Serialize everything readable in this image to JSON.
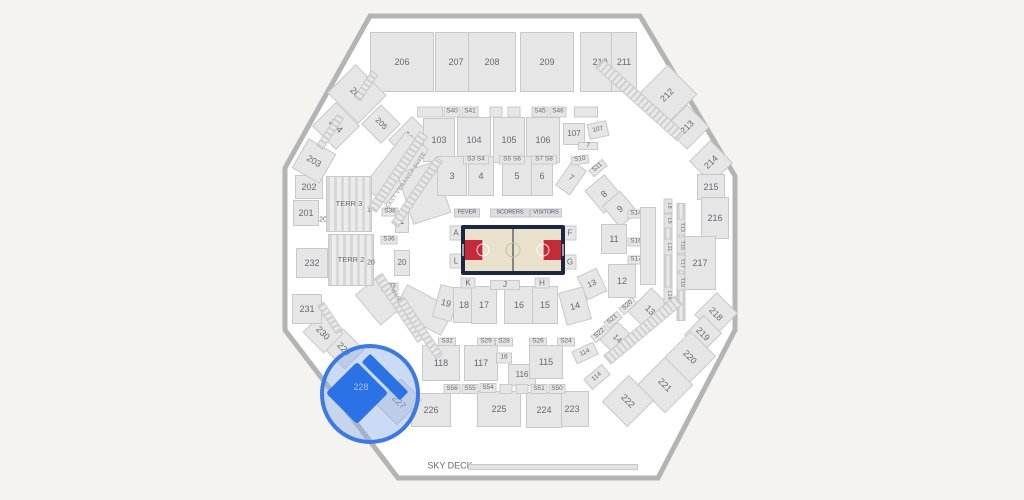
{
  "selection": {
    "section": "228"
  },
  "colors": {
    "bg": "#f5f3ef",
    "arenaFill": "#ffffff",
    "arenaStroke": "#b4b4b4",
    "secFill": "#e6e6e6",
    "secEdge": "#c9c9c9",
    "secText": "#68686f",
    "navy": "#1b2843",
    "floor": "#e9e1cb",
    "red": "#c62a39",
    "selFill": "#2a72e6",
    "selRing": "#3b7ae2",
    "selHalo": "rgba(141,175,232,0.45)",
    "selText": "#a5bfe8"
  },
  "court": {
    "bench_labels": [
      "FEVER",
      "SCORERS",
      "VISITORS"
    ]
  },
  "map": {
    "blocks": [
      [
        "206",
        402,
        62,
        64,
        60,
        0,
        "sec"
      ],
      [
        "207",
        456,
        62,
        42,
        60,
        0,
        "sec"
      ],
      [
        "208",
        492,
        62,
        48,
        60,
        0,
        "sec"
      ],
      [
        "209",
        547,
        62,
        54,
        60,
        0,
        "sec"
      ],
      [
        "210",
        600,
        62,
        40,
        60,
        0,
        "sec"
      ],
      [
        "211",
        624,
        62,
        26,
        60,
        0,
        "sec"
      ],
      [
        "205",
        357,
        94,
        44,
        40,
        45,
        "sec"
      ],
      [
        "205",
        381,
        124,
        28,
        28,
        45,
        "sec sm"
      ],
      [
        "204",
        336,
        126,
        34,
        34,
        45,
        "sec"
      ],
      [
        "212",
        667,
        95,
        44,
        42,
        -45,
        "sec"
      ],
      [
        "213",
        687,
        127,
        32,
        32,
        -45,
        "sec"
      ],
      [
        "214",
        711,
        162,
        30,
        32,
        -45,
        "sec"
      ],
      [
        "215",
        711,
        187,
        28,
        26,
        0,
        "sec"
      ],
      [
        "216",
        715,
        218,
        28,
        42,
        0,
        "sec"
      ],
      [
        "217",
        700,
        263,
        32,
        54,
        0,
        "sec"
      ],
      [
        "218",
        716,
        314,
        30,
        32,
        45,
        "sec"
      ],
      [
        "219",
        703,
        334,
        26,
        28,
        45,
        "sec"
      ],
      [
        "220",
        690,
        357,
        36,
        38,
        45,
        "sec"
      ],
      [
        "221",
        665,
        385,
        40,
        40,
        45,
        "sec"
      ],
      [
        "222",
        628,
        401,
        36,
        38,
        45,
        "sec"
      ],
      [
        "223",
        572,
        409,
        34,
        36,
        0,
        "sec"
      ],
      [
        "224",
        544,
        410,
        36,
        36,
        0,
        "sec"
      ],
      [
        "225",
        499,
        409,
        44,
        36,
        0,
        "sec"
      ],
      [
        "226",
        431,
        410,
        40,
        34,
        0,
        "sec"
      ],
      [
        "227",
        399,
        402,
        30,
        36,
        45,
        "sec"
      ],
      [
        "229",
        344,
        349,
        30,
        28,
        45,
        "sec"
      ],
      [
        "230",
        323,
        333,
        30,
        28,
        45,
        "sec"
      ],
      [
        "231",
        307,
        309,
        30,
        30,
        0,
        "sec"
      ],
      [
        "232",
        312,
        263,
        32,
        30,
        0,
        "sec"
      ],
      [
        "201",
        306,
        213,
        26,
        26,
        0,
        "sec"
      ],
      [
        "201",
        325,
        220,
        0,
        0,
        0,
        "lbl lblxs"
      ],
      [
        "202",
        309,
        187,
        28,
        24,
        0,
        "sec"
      ],
      [
        "203",
        314,
        161,
        32,
        34,
        30,
        "sec"
      ],
      [
        "102",
        410,
        138,
        28,
        34,
        45,
        "sec"
      ],
      [
        "103",
        439,
        140,
        32,
        44,
        0,
        "sec"
      ],
      [
        "104",
        474,
        140,
        34,
        46,
        0,
        "sec"
      ],
      [
        "105",
        509,
        140,
        32,
        46,
        0,
        "sec"
      ],
      [
        "106",
        543,
        140,
        34,
        46,
        0,
        "sec"
      ],
      [
        "107",
        574,
        134,
        22,
        22,
        0,
        "sec sm"
      ],
      [
        "107",
        598,
        130,
        20,
        16,
        -12,
        "sec xs"
      ],
      [
        "7",
        588,
        146,
        20,
        8,
        0,
        "sec xs"
      ],
      [
        "",
        430,
        112,
        26,
        11,
        0,
        "sec xs"
      ],
      [
        "S40",
        452,
        112,
        17,
        11,
        0,
        "sec xs"
      ],
      [
        "S41",
        470,
        112,
        17,
        11,
        0,
        "sec xs"
      ],
      [
        "",
        496,
        112,
        13,
        11,
        0,
        "sec xs"
      ],
      [
        "",
        514,
        112,
        13,
        11,
        0,
        "sec xs"
      ],
      [
        "S45",
        540,
        112,
        17,
        11,
        0,
        "sec xs"
      ],
      [
        "S46",
        558,
        112,
        17,
        11,
        0,
        "sec xs"
      ],
      [
        "",
        586,
        112,
        24,
        11,
        0,
        "sec xs"
      ],
      [
        "",
        396,
        168,
        70,
        30,
        -52,
        "sec"
      ],
      [
        "",
        424,
        193,
        40,
        54,
        -18,
        "sec"
      ],
      [
        "",
        424,
        310,
        54,
        30,
        28,
        "sec"
      ],
      [
        "",
        380,
        300,
        32,
        40,
        -40,
        "sec"
      ],
      [
        "3",
        452,
        176,
        30,
        40,
        0,
        "sec"
      ],
      [
        "4",
        481,
        176,
        26,
        40,
        0,
        "sec"
      ],
      [
        "5",
        517,
        176,
        30,
        40,
        0,
        "sec"
      ],
      [
        "6",
        542,
        176,
        22,
        40,
        0,
        "sec"
      ],
      [
        "7",
        571,
        178,
        18,
        30,
        35,
        "sec sm"
      ],
      [
        "S3 S4",
        476,
        160,
        26,
        9,
        0,
        "sec xs"
      ],
      [
        "S5 S6",
        512,
        160,
        26,
        9,
        0,
        "sec xs"
      ],
      [
        "S7 S8",
        544,
        160,
        26,
        9,
        0,
        "sec xs"
      ],
      [
        "S10",
        580,
        160,
        18,
        9,
        -8,
        "sec xs"
      ],
      [
        "S11",
        598,
        168,
        18,
        9,
        -40,
        "sec xs"
      ],
      [
        "8",
        604,
        194,
        26,
        30,
        -40,
        "sec"
      ],
      [
        "9",
        620,
        209,
        24,
        28,
        -40,
        "sec"
      ],
      [
        "S14",
        636,
        214,
        17,
        9,
        0,
        "sec xs"
      ],
      [
        "11",
        614,
        239,
        26,
        30,
        0,
        "sec"
      ],
      [
        "S16",
        636,
        242,
        17,
        9,
        0,
        "sec xs"
      ],
      [
        "S17",
        636,
        260,
        17,
        9,
        0,
        "sec xs"
      ],
      [
        "12",
        622,
        281,
        28,
        34,
        0,
        "sec"
      ],
      [
        "S20",
        628,
        306,
        18,
        9,
        -40,
        "sec xs"
      ],
      [
        "S21",
        613,
        320,
        18,
        9,
        -40,
        "sec xs"
      ],
      [
        "S22",
        600,
        334,
        18,
        9,
        -40,
        "sec xs"
      ],
      [
        "13",
        650,
        310,
        30,
        34,
        45,
        "sec"
      ],
      [
        "13",
        592,
        284,
        22,
        26,
        -25,
        "sec sm"
      ],
      [
        "14",
        617,
        339,
        24,
        26,
        45,
        "sec sm"
      ],
      [
        "",
        648,
        246,
        16,
        78,
        0,
        "sec"
      ],
      [
        "",
        668,
        256,
        9,
        112,
        0,
        "stripe"
      ],
      [
        "",
        681,
        262,
        9,
        118,
        0,
        "stripe"
      ],
      [
        "L8",
        668,
        206,
        9,
        15,
        0,
        "vlbl"
      ],
      [
        "L9",
        668,
        221,
        9,
        15,
        0,
        "vlbl"
      ],
      [
        "L11",
        668,
        247,
        9,
        17,
        0,
        "vlbl"
      ],
      [
        "L14",
        668,
        295,
        9,
        17,
        0,
        "vlbl"
      ],
      [
        "T13",
        681,
        227,
        9,
        17,
        0,
        "vlbl"
      ],
      [
        "T15",
        681,
        245,
        9,
        17,
        0,
        "vlbl"
      ],
      [
        "T17",
        681,
        263,
        9,
        17,
        0,
        "vlbl"
      ],
      [
        "T19",
        681,
        282,
        9,
        17,
        0,
        "vlbl"
      ],
      [
        "19",
        446,
        303,
        20,
        34,
        15,
        "sec"
      ],
      [
        "18",
        464,
        305,
        22,
        36,
        0,
        "sec"
      ],
      [
        "17",
        484,
        305,
        26,
        38,
        0,
        "sec"
      ],
      [
        "16",
        519,
        305,
        30,
        38,
        0,
        "sec"
      ],
      [
        "15",
        545,
        305,
        26,
        38,
        0,
        "sec"
      ],
      [
        "14",
        575,
        306,
        26,
        34,
        -15,
        "sec"
      ],
      [
        "S32",
        447,
        342,
        18,
        9,
        0,
        "sec xs"
      ],
      [
        "S29",
        486,
        342,
        18,
        9,
        0,
        "sec xs"
      ],
      [
        "S28",
        504,
        342,
        18,
        9,
        0,
        "sec xs"
      ],
      [
        "S26",
        538,
        342,
        18,
        9,
        0,
        "sec xs"
      ],
      [
        "S24",
        566,
        342,
        18,
        9,
        0,
        "sec xs"
      ],
      [
        "118",
        441,
        363,
        38,
        36,
        0,
        "sec"
      ],
      [
        "117",
        481,
        363,
        34,
        36,
        0,
        "sec"
      ],
      [
        "16",
        504,
        358,
        16,
        11,
        0,
        "sec xs"
      ],
      [
        "116",
        522,
        375,
        28,
        22,
        0,
        "sec sm"
      ],
      [
        "115",
        546,
        362,
        34,
        34,
        0,
        "sec"
      ],
      [
        "114",
        585,
        353,
        24,
        14,
        -25,
        "sec xs"
      ],
      [
        "114",
        597,
        377,
        24,
        14,
        -40,
        "sec xs"
      ],
      [
        "S56",
        452,
        389,
        17,
        10,
        0,
        "sec xs"
      ],
      [
        "S55",
        470,
        389,
        17,
        10,
        0,
        "sec xs"
      ],
      [
        "S54",
        488,
        388,
        17,
        10,
        0,
        "sec xs"
      ],
      [
        "",
        506,
        389,
        13,
        10,
        0,
        "sec xs"
      ],
      [
        "",
        522,
        389,
        13,
        10,
        0,
        "sec xs"
      ],
      [
        "S51",
        539,
        389,
        17,
        10,
        0,
        "sec xs"
      ],
      [
        "S50",
        557,
        389,
        17,
        10,
        0,
        "sec xs"
      ],
      [
        "TERR 3",
        349,
        204,
        46,
        56,
        0,
        "terr"
      ],
      [
        "1",
        369,
        210,
        0,
        0,
        0,
        "lbl lblxs"
      ],
      [
        "TERR 2",
        351,
        260,
        46,
        52,
        0,
        "terr"
      ],
      [
        "20",
        371,
        263,
        0,
        0,
        0,
        "lbl lblxs"
      ],
      [
        "S38",
        390,
        212,
        17,
        9,
        0,
        "sec xs"
      ],
      [
        "1",
        402,
        222,
        14,
        22,
        0,
        "sec sm"
      ],
      [
        "S36",
        389,
        240,
        17,
        9,
        0,
        "sec xs"
      ],
      [
        "20",
        402,
        263,
        16,
        26,
        0,
        "sec sm"
      ],
      [
        "S33",
        390,
        287,
        17,
        9,
        0,
        "sec xs"
      ],
      [
        "A",
        456,
        233,
        13,
        15,
        0,
        "sec sm"
      ],
      [
        "L",
        456,
        261,
        13,
        15,
        0,
        "sec sm"
      ],
      [
        "F",
        570,
        233,
        13,
        15,
        0,
        "sec sm"
      ],
      [
        "G",
        570,
        262,
        13,
        15,
        0,
        "sec sm"
      ],
      [
        "K",
        468,
        283,
        15,
        11,
        0,
        "sec sm"
      ],
      [
        "J",
        505,
        285,
        30,
        10,
        0,
        "sec sm"
      ],
      [
        "H",
        542,
        283,
        15,
        11,
        0,
        "sec sm"
      ],
      [
        "FEVER",
        467,
        213,
        26,
        9,
        0,
        "bench"
      ],
      [
        "SCORERS",
        510,
        213,
        40,
        9,
        0,
        "bench"
      ],
      [
        "VISITORS",
        546,
        213,
        32,
        9,
        0,
        "bench"
      ],
      [
        "",
        398,
        172,
        92,
        10,
        -56,
        "stripe"
      ],
      [
        "EAST VERANDA SUITE",
        407,
        181,
        0,
        0,
        -56,
        "lbl lbltiny"
      ],
      [
        "",
        417,
        192,
        80,
        9,
        -56,
        "stripe"
      ],
      [
        "",
        400,
        308,
        78,
        10,
        56,
        "stripe"
      ],
      [
        "WEST VERANDA SUITE",
        410,
        318,
        0,
        0,
        56,
        "lbl lbltiny"
      ],
      [
        "",
        420,
        328,
        70,
        9,
        56,
        "stripe"
      ],
      [
        "",
        640,
        100,
        110,
        12,
        42,
        "stripe"
      ],
      [
        "",
        643,
        330,
        94,
        12,
        -40,
        "stripe"
      ],
      [
        "",
        330,
        132,
        38,
        8,
        -56,
        "stripe"
      ],
      [
        "",
        330,
        318,
        34,
        8,
        56,
        "stripe"
      ],
      [
        "",
        366,
        86,
        32,
        8,
        -56,
        "stripe"
      ],
      [
        "SKY DECK",
        450,
        466,
        0,
        0,
        0,
        "lbl"
      ],
      [
        "",
        553,
        467,
        170,
        6,
        0,
        "bar"
      ]
    ]
  }
}
